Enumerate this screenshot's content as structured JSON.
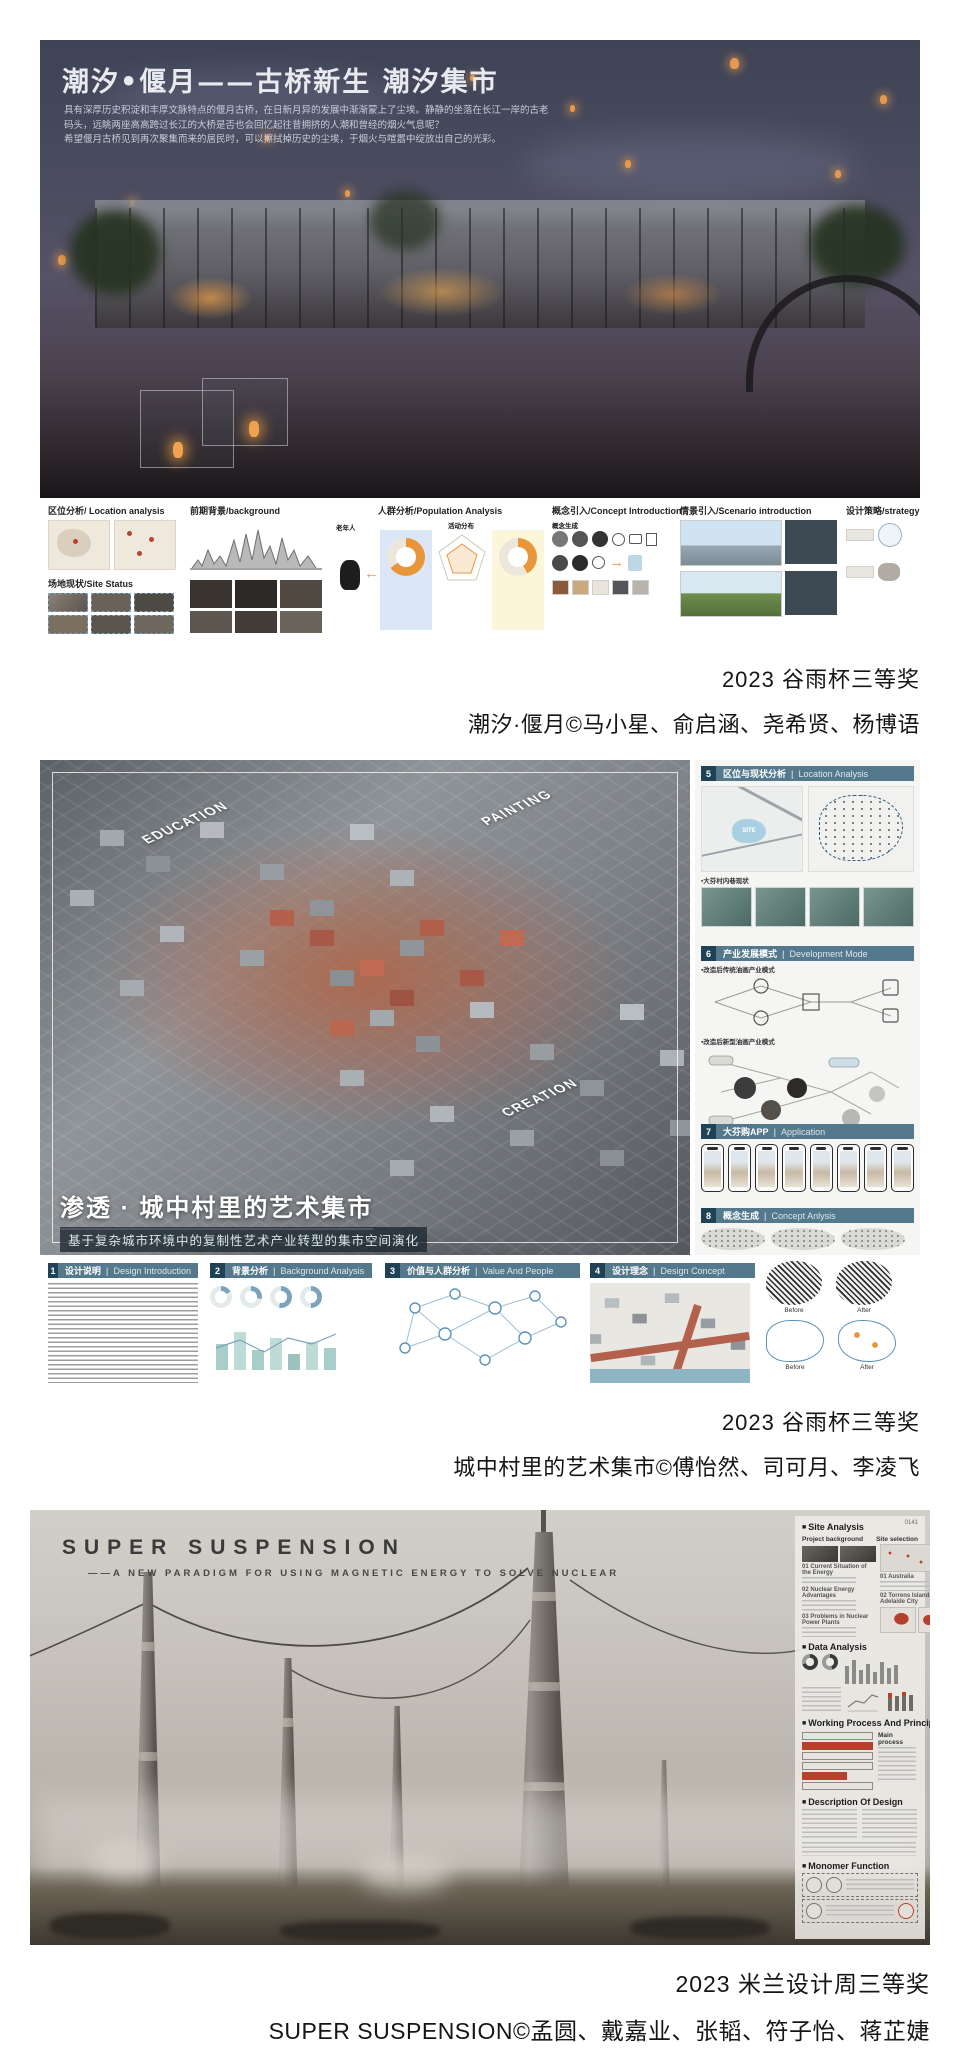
{
  "awards": [
    {
      "title": "2023 谷雨杯三等奖",
      "credit": "潮汐·偃月©马小星、俞启涵、尧希贤、杨博语"
    },
    {
      "title": "2023 谷雨杯三等奖",
      "credit": "城中村里的艺术集市©傅怡然、司可月、李凌飞"
    },
    {
      "title": "2023 米兰设计周三等奖",
      "credit": "SUPER SUSPENSION©孟圆、戴嘉业、张韬、符子怡、蒋芷婕"
    }
  ],
  "poster_tide": {
    "title": "潮汐•偃月——古桥新生 潮汐集市",
    "intro_1": "具有深厚历史积淀和丰厚文脉特点的偃月古桥，在日新月异的发展中渐渐蒙上了尘埃。静静的坐落在长江一岸的古老码头，远眺两座高高跨过长江的大桥是否也会回忆起往昔拥挤的人潮和曾经的烟火气息呢？",
    "intro_2": "希望偃月古桥见到再次聚集而来的居民时，可以擦拭掉历史的尘埃，于烟火与喧嚣中绽放出自己的光彩。",
    "sections": [
      {
        "title": "区位分析/ Location analysis"
      },
      {
        "title": "场地现状/Site Status"
      },
      {
        "title": "前期背景/background"
      },
      {
        "title": "人群分析/Population Analysis"
      },
      {
        "title": "概念引入/Concept Introduction"
      },
      {
        "title": "情景引入/Scenario introduction"
      },
      {
        "title": "设计策略/strategy"
      }
    ],
    "labels": {
      "elderly": "老年人",
      "activity": "活动分布",
      "concept_gen": "概念生成"
    }
  },
  "poster_art": {
    "title": "渗透 · 城中村里的艺术集市",
    "subtitle": "基于复杂城市环境中的复制性艺术产业转型的集市空间演化",
    "iso_labels": {
      "education": "EDUCATION",
      "painting": "PAINTING",
      "creation": "CREATION"
    },
    "site_label": "SITE",
    "bottom_sections": [
      {
        "num": "1",
        "zh": "设计说明",
        "en": "Design Introduction"
      },
      {
        "num": "2",
        "zh": "背景分析",
        "en": "Background Analysis"
      },
      {
        "num": "3",
        "zh": "价值与人群分析",
        "en": "Value And People"
      },
      {
        "num": "4",
        "zh": "设计理念",
        "en": "Design Concept"
      }
    ],
    "side_sections": [
      {
        "num": "5",
        "zh": "区位与现状分析",
        "en": "Location Analysis"
      },
      {
        "num": "6",
        "zh": "产业发展模式",
        "en": "Development Mode"
      },
      {
        "num": "7",
        "zh": "大芬购APP",
        "en": "Application"
      },
      {
        "num": "8",
        "zh": "概念生成",
        "en": "Concept Anlysis"
      }
    ],
    "side_notes": {
      "lane": "▪大芬村内巷现状",
      "mode_traditional": "▪改造后传统油画产业模式",
      "mode_new": "▪改造后新型油画产业模式"
    },
    "before_label": "Before",
    "after_label": "After"
  },
  "poster_super": {
    "title": "SUPER SUSPENSION",
    "subtitle": "——A NEW PARADIGM FOR USING MAGNETIC ENERGY TO SOLVE NUCLEAR",
    "corner_number": "0141",
    "sections": [
      {
        "title": "Site Analysis"
      },
      {
        "title": "Data Analysis"
      },
      {
        "title": "Working Process And Principle"
      },
      {
        "title": "Description Of Design"
      },
      {
        "title": "Monomer Function"
      }
    ],
    "sub_labels": {
      "project_background": "Project background",
      "site_selection": "Site selection",
      "loc_1": "01 Australia",
      "loc_2": "02 Torrens Island, Adelaide City"
    },
    "site_items": [
      "01 Current Situation of the Energy",
      "02 Nuclear Energy Advantages",
      "03 Problems in Nuclear Power Plants"
    ],
    "main_process_label": "Main process"
  }
}
